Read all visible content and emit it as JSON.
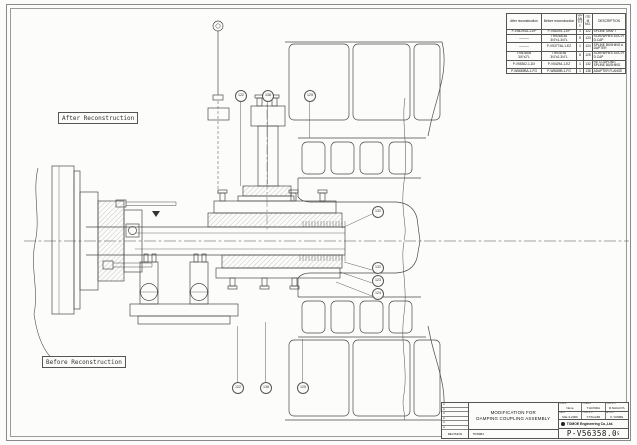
{
  "labels": {
    "after": "After Reconstruction",
    "before": "Before Reconstruction"
  },
  "parts_table": {
    "headers": {
      "after": "After reconstruction",
      "before": "Before reconstruction",
      "qty": "QUAN\nTITY",
      "item": "ITEM\nNO.",
      "description": "DESCRIPTION"
    },
    "rows": [
      {
        "after": "P-V5429SA-1-EP",
        "before": "P-V5429S-1-EP",
        "qty": "1",
        "item": "122",
        "desc": "SPLINE SHAFT"
      },
      {
        "after": "———",
        "before": "TRN-6A/3A\n3/4\"x1-3/4\"L",
        "qty": "8",
        "item": "123",
        "desc": "SCREW:HEX.SOC.HD.CAP"
      },
      {
        "after": "———",
        "before": "P-V53773A-1-EZ",
        "qty": "1",
        "item": "124",
        "desc": "SPLINE BUSHING ADAPTER"
      },
      {
        "after": "TRN-6A/B\n3/4\"x2\"L",
        "before": "TRN-6/3B\n3/4\"x2-3/4\"L",
        "qty": "8",
        "item": "125",
        "desc": "SCREW:HEX.SOC.HD.CAP"
      },
      {
        "after": "P-V55302-1-DX",
        "before": "P-V5429A-1-EZ",
        "qty": "1",
        "item": "132",
        "desc": "RE COUPLING\nSPLINE BUSHING"
      },
      {
        "after": "P-W5669BA-1-FG",
        "before": "P-W5669B-1-FG",
        "qty": "1",
        "item": "138",
        "desc": "ADAPTER FLANGE"
      }
    ]
  },
  "callouts": [
    {
      "label": "122"
    },
    {
      "label": "138"
    },
    {
      "label": "125"
    },
    {
      "label": "132"
    },
    {
      "label": "132"
    },
    {
      "label": "123"
    },
    {
      "label": "124"
    },
    {
      "label": "122"
    },
    {
      "label": "138"
    },
    {
      "label": "125"
    }
  ],
  "title_block": {
    "revision_marks": [
      "A",
      "A",
      "A",
      "A",
      "A",
      "A"
    ],
    "revision_label": "REVISION",
    "title_line1": "MODIFICATION FOR",
    "title_line2": "DAMPING COUPLING ASSEMBLY",
    "doc_code": "TRN084",
    "scale_label": "SCALE",
    "scale_value": "None",
    "drawn_label": "DRAWN",
    "drawn_value": "T.HONDA",
    "checked_label": "CHECK'D",
    "checked_value": "R.NAGOYA",
    "date_label": "DATE",
    "date_value": "Mar-3-2009",
    "checked2_label": "CHECK'D",
    "checked2_value": "T.TAGAMI",
    "approved_label": "APPR'D",
    "approved_value": "K.YANBE",
    "company": "TOMOE Engineering Co.,Ltd.",
    "drawing_number": "P-V56358.0",
    "drawing_number_suffix": "S"
  },
  "colors": {
    "line": "#4a4a4a",
    "paper": "#fcfcfa"
  }
}
